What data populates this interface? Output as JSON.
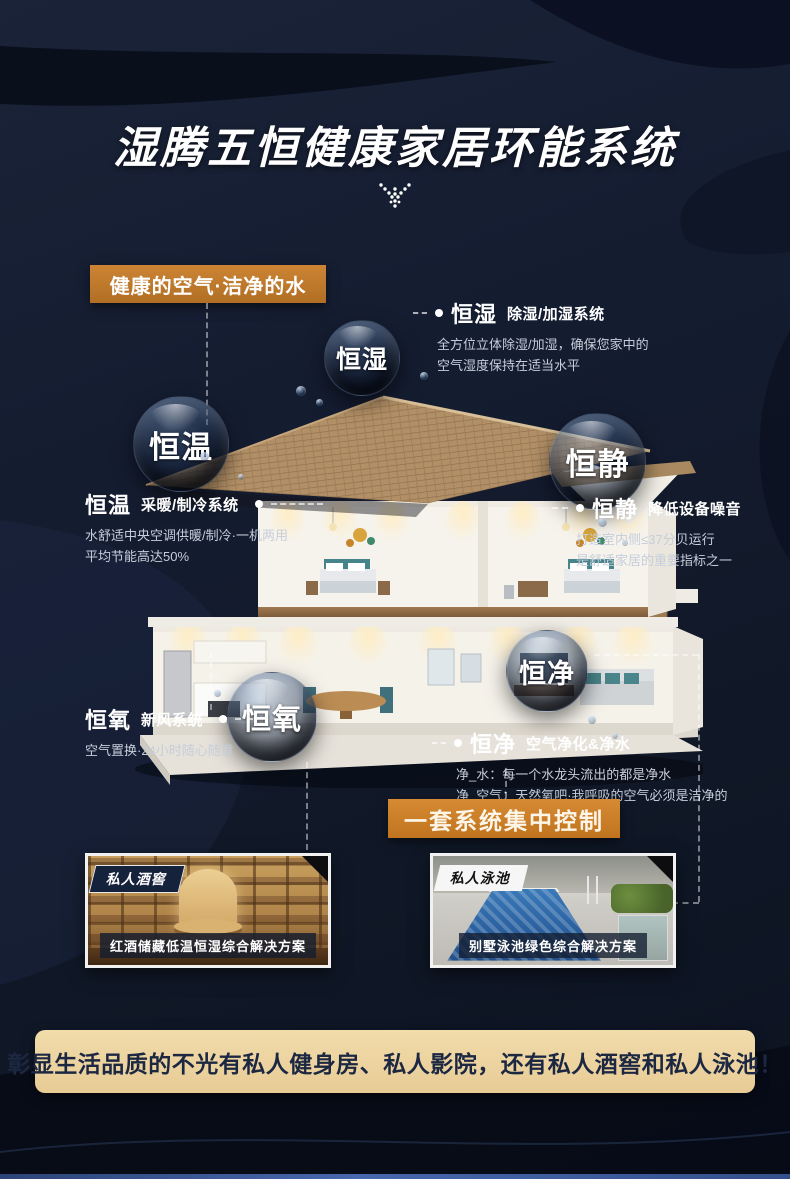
{
  "title": "湿腾五恒健康家居环能系统",
  "badge_label": "健康的空气·洁净的水",
  "control_banner_label": "一套系统集中控制",
  "bottom_banner_text": "彰显生活品质的不光有私人健身房、私人影院，还有私人酒窖和私人泳池！",
  "colors": {
    "accent_orange": "#c57a28",
    "banner_cream": "#eed7a6",
    "background_navy": "#141c30",
    "bottom_strip_blue": "#4767ae"
  },
  "features": {
    "hengshi": {
      "bubble_label": "恒湿",
      "name": "恒湿",
      "system": "除湿/加湿系统",
      "desc1": "全方位立体除湿/加湿，确保您家中的",
      "desc2": "空气湿度保持在适当水平"
    },
    "hengwen": {
      "bubble_label": "恒温",
      "name": "恒温",
      "system": "采暖/制冷系统",
      "desc1": "水舒适中央空调供暖/制冷·一机两用",
      "desc2": "平均节能高达50%"
    },
    "hengjing": {
      "bubble_label": "恒静",
      "name": "恒静",
      "system": "降低设备噪音",
      "desc1": "打造室内侧≤37分贝运行",
      "desc2": "是舒适家居的重要指标之一"
    },
    "hengyang": {
      "bubble_label": "恒氧",
      "name": "恒氧",
      "system": "新风系统",
      "desc1": "空气置换·24小时随心随意"
    },
    "hengjing_water": {
      "bubble_label": "恒净",
      "name": "恒净",
      "system": "空气净化&净水",
      "desc1": "净_水：每一个水龙头流出的都是净水",
      "desc2": "净_空气：天然氧吧·我呼吸的空气必须是洁净的"
    }
  },
  "cards": {
    "wine": {
      "tag": "私人酒窖",
      "caption": "红酒储藏低温恒湿综合解决方案"
    },
    "pool": {
      "tag": "私人泳池",
      "caption": "别墅泳池绿色综合解决方案"
    }
  }
}
